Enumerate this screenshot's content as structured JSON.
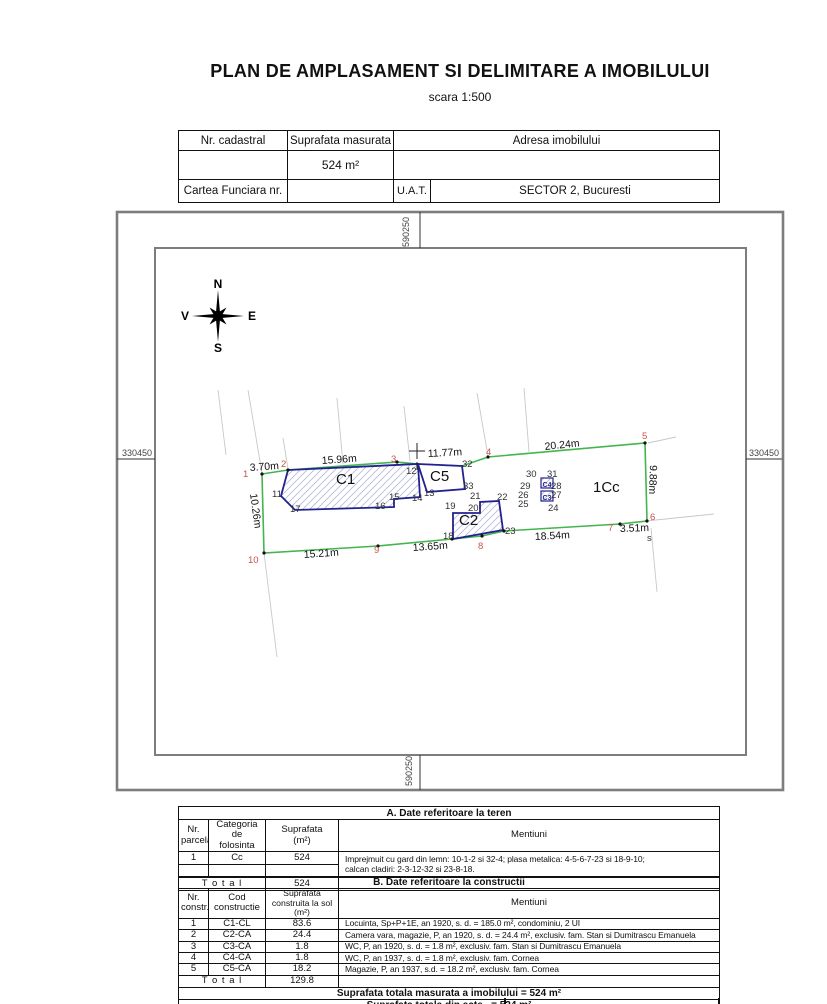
{
  "title": "PLAN DE AMPLASAMENT SI DELIMITARE A IMOBILULUI",
  "scale": "scara 1:500",
  "header_table": {
    "nr_cadastral": "Nr. cadastral",
    "suprafata_masurata": "Suprafata masurata",
    "adresa": "Adresa imobilului",
    "suprafata_value": "524 m²",
    "cartea_funciara": "Cartea Funciara nr.",
    "uat": "U.A.T.",
    "uat_value": "SECTOR 2, Bucuresti"
  },
  "map": {
    "coords": {
      "top": "590250",
      "bottom": "590250",
      "left": "330450",
      "right": "330450"
    },
    "compass": {
      "n": "N",
      "e": "E",
      "s": "S",
      "v": "V"
    },
    "colors": {
      "boundary_green": "#44b54e",
      "building_blue": "#22228e",
      "point_red": "#c7524a",
      "hatch": "#b4b9d8"
    },
    "labels": [
      {
        "t": "1",
        "x": 243,
        "y": 477,
        "c": "red"
      },
      {
        "t": "2",
        "x": 281,
        "y": 467,
        "c": "red"
      },
      {
        "t": "3",
        "x": 391,
        "y": 462,
        "c": "red"
      },
      {
        "t": "4",
        "x": 486,
        "y": 455,
        "c": "red"
      },
      {
        "t": "5",
        "x": 642,
        "y": 439,
        "c": "red"
      },
      {
        "t": "6",
        "x": 650,
        "y": 520,
        "c": "red"
      },
      {
        "t": "7",
        "x": 608,
        "y": 531,
        "c": "red"
      },
      {
        "t": "8",
        "x": 478,
        "y": 549,
        "c": "red"
      },
      {
        "t": "9",
        "x": 374,
        "y": 553,
        "c": "red"
      },
      {
        "t": "10",
        "x": 248,
        "y": 563,
        "c": "red"
      },
      {
        "t": "11",
        "x": 272,
        "y": 497
      },
      {
        "t": "12",
        "x": 406,
        "y": 474
      },
      {
        "t": "13",
        "x": 424,
        "y": 496
      },
      {
        "t": "14",
        "x": 412,
        "y": 501
      },
      {
        "t": "15",
        "x": 389,
        "y": 500
      },
      {
        "t": "16",
        "x": 375,
        "y": 509
      },
      {
        "t": "17",
        "x": 290,
        "y": 512
      },
      {
        "t": "18",
        "x": 443,
        "y": 539
      },
      {
        "t": "19",
        "x": 445,
        "y": 509
      },
      {
        "t": "20",
        "x": 468,
        "y": 511
      },
      {
        "t": "21",
        "x": 470,
        "y": 499
      },
      {
        "t": "22",
        "x": 497,
        "y": 500
      },
      {
        "t": "23",
        "x": 505,
        "y": 534
      },
      {
        "t": "24",
        "x": 548,
        "y": 511
      },
      {
        "t": "25",
        "x": 518,
        "y": 507
      },
      {
        "t": "26",
        "x": 518,
        "y": 498
      },
      {
        "t": "27",
        "x": 551,
        "y": 498
      },
      {
        "t": "28",
        "x": 551,
        "y": 489
      },
      {
        "t": "29",
        "x": 520,
        "y": 489
      },
      {
        "t": "30",
        "x": 526,
        "y": 477
      },
      {
        "t": "31",
        "x": 547,
        "y": 477
      },
      {
        "t": "32",
        "x": 462,
        "y": 467
      },
      {
        "t": "33",
        "x": 463,
        "y": 489
      },
      {
        "t": "s",
        "x": 647,
        "y": 541
      },
      {
        "t": "3.70m",
        "x": 250,
        "y": 471,
        "c": "meas",
        "r": -4
      },
      {
        "t": "15.96m",
        "x": 322,
        "y": 464,
        "c": "meas",
        "r": -4
      },
      {
        "t": "11.77m",
        "x": 428,
        "y": 457,
        "c": "meas",
        "r": -3
      },
      {
        "t": "20.24m",
        "x": 545,
        "y": 450,
        "c": "meas",
        "r": -6
      },
      {
        "t": "9.88m",
        "x": 650,
        "y": 465,
        "c": "meas",
        "r": 92
      },
      {
        "t": "10.26m",
        "x": 250,
        "y": 494,
        "c": "meas",
        "r": 82
      },
      {
        "t": "15.21m",
        "x": 304,
        "y": 558,
        "c": "meas",
        "r": -4
      },
      {
        "t": "13.65m",
        "x": 413,
        "y": 551,
        "c": "meas",
        "r": -4
      },
      {
        "t": "18.54m",
        "x": 535,
        "y": 540,
        "c": "meas",
        "r": -3
      },
      {
        "t": "3.51m",
        "x": 620,
        "y": 532,
        "c": "meas",
        "r": -2
      },
      {
        "t": "C1",
        "x": 336,
        "y": 484,
        "c": "bldg"
      },
      {
        "t": "C5",
        "x": 430,
        "y": 481,
        "c": "bldg"
      },
      {
        "t": "C2",
        "x": 459,
        "y": 525,
        "c": "bldg"
      },
      {
        "t": "1Cc",
        "x": 593,
        "y": 492,
        "c": "bldg"
      },
      {
        "t": "C4",
        "x": 547,
        "y": 487,
        "c": "bsm",
        "a": "middle"
      },
      {
        "t": "C3",
        "x": 547,
        "y": 500,
        "c": "bsm",
        "a": "middle"
      }
    ]
  },
  "table_a": {
    "section_title": "A. Date referitoare la teren",
    "headers": [
      "Nr.\nparcela",
      "Categoria de\nfolosinta",
      "Suprafata\n(m²)",
      "Mentiuni"
    ],
    "row": {
      "nr": "1",
      "categoria": "Cc",
      "suprafata": "524"
    },
    "mentiuni": "Imprejmuit cu gard din lemn: 10-1-2 si 32-4; plasa metalica: 4-5-6-7-23 si 18-9-10;\ncalcan cladiri: 2-3-12-32 si 23-8-18.",
    "total_label": "T o t a l",
    "total_value": "524"
  },
  "table_b": {
    "section_title": "B. Date referitoare la constructii",
    "headers": [
      "Nr.\nconstr.",
      "Cod\nconstructie",
      "Suprafata\nconstruita la sol (m²)",
      "Mentiuni"
    ],
    "rows": [
      {
        "nr": "1",
        "cod": "C1-CL",
        "suprafata": "83.6",
        "mentiuni": "Locuinta, Sp+P+1E, an 1920, s. d. = 185.0 m², condominiu, 2 UI"
      },
      {
        "nr": "2",
        "cod": "C2-CA",
        "suprafata": "24.4",
        "mentiuni": "Camera vara, magazie, P, an 1920, s. d. = 24.4 m², exclusiv. fam. Stan si Dumitrascu Emanuela"
      },
      {
        "nr": "3",
        "cod": "C3-CA",
        "suprafata": "1.8",
        "mentiuni": "WC, P, an 1920, s. d. = 1.8 m², exclusiv. fam. Stan si Dumitrascu Emanuela"
      },
      {
        "nr": "4",
        "cod": "C4-CA",
        "suprafata": "1.8",
        "mentiuni": "WC, P, an 1937, s. d. = 1.8 m², exclusiv. fam. Cornea"
      },
      {
        "nr": "5",
        "cod": "C5-CA",
        "suprafata": "18.2",
        "mentiuni": "Magazie, P, an 1937, s.d. = 18.2 m², exclusiv. fam. Cornea"
      }
    ],
    "total_label": "T o t a l",
    "total_value": "129.8"
  },
  "summary": {
    "line1": "Suprafata totala masurata a imobilului = 524 m²",
    "line2": "Suprafata totala din acte   = 524 m²"
  }
}
